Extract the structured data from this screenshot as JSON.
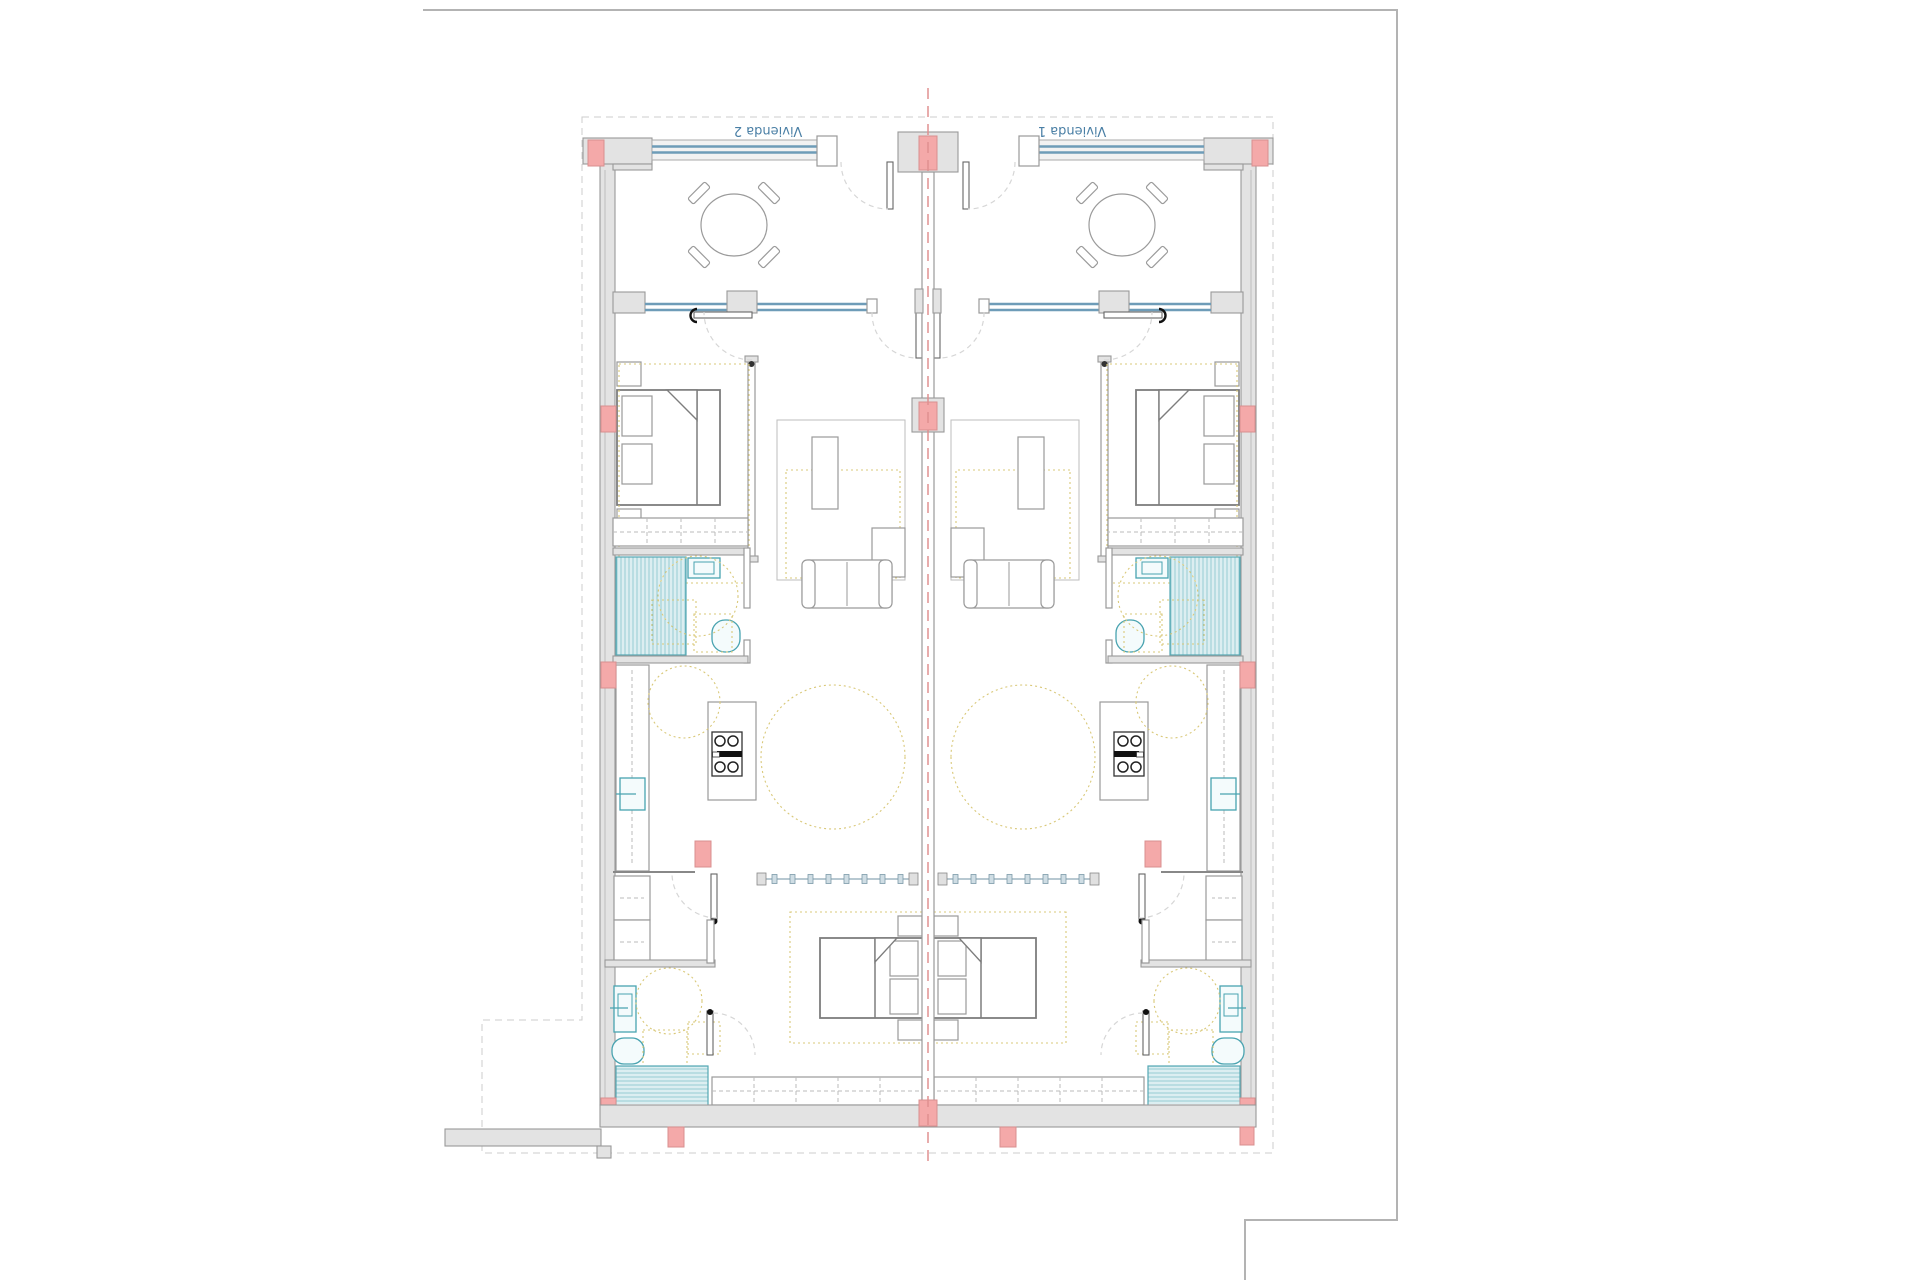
{
  "plan": {
    "labels": {
      "unit_left": "Vivienda 2",
      "unit_right": "Vivienda 1"
    },
    "colors": {
      "frame": "#b3b3b3",
      "boundary_dash": "#cccccc",
      "centerline": "#e09090",
      "wall_fill": "#e3e3e3",
      "wall_stroke": "#999999",
      "column_fill": "#f4a9a9",
      "column_stroke": "#d88f8f",
      "glazing": "#6e9cb8",
      "fixture": "#49a3b0",
      "ceiling_dash": "#d9c878",
      "door_arc": "#d6d6d6",
      "furniture": "#9a9a9a",
      "label_text": "#4a7fa5",
      "hob": "#111111",
      "hatch_line": "#7fc0c9",
      "hatch_line_light": "#c5e3e7",
      "background": "#ffffff"
    }
  }
}
